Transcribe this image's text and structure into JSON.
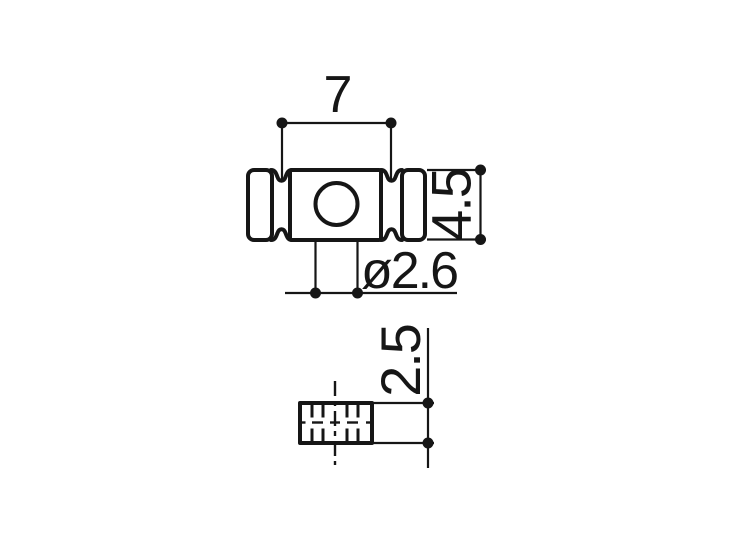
{
  "page": {
    "background": "#ffffff",
    "line_color": "#161616"
  },
  "drawing": {
    "kind": "technical-dimension-drawing",
    "views": [
      "front-view-barrel",
      "end-view"
    ],
    "dimensions": {
      "groove_span": {
        "label": "7"
      },
      "barrel_diameter": {
        "label": "4.5"
      },
      "hole_diameter": {
        "label": "ø2.6"
      },
      "barrel_height": {
        "label": "2.5"
      }
    }
  }
}
